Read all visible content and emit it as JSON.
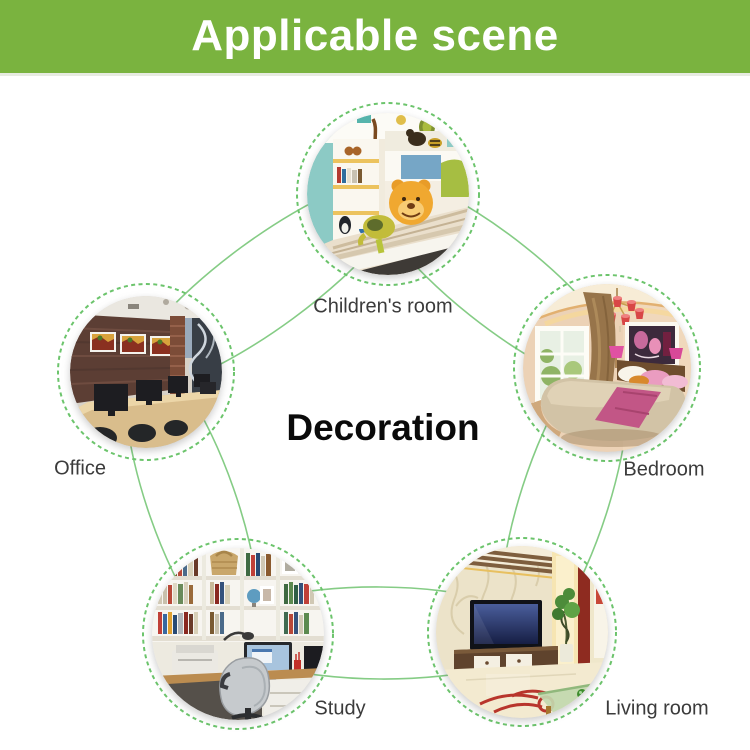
{
  "header": {
    "title": "Applicable scene"
  },
  "center_label": "Decoration",
  "scenes": [
    {
      "id": "children-room",
      "label": "Children's room"
    },
    {
      "id": "office",
      "label": "Office"
    },
    {
      "id": "bedroom",
      "label": "Bedroom"
    },
    {
      "id": "study",
      "label": "Study"
    },
    {
      "id": "living-room",
      "label": "Living room"
    }
  ],
  "colors": {
    "page_bg": "#ffffff",
    "header_bg": "#7ab33f",
    "header_text": "#ffffff",
    "ring_green": "#85cc85",
    "dash_green": "#6cc46c",
    "label_text": "#3b3b3b",
    "center_text": "#0a0a0a"
  }
}
